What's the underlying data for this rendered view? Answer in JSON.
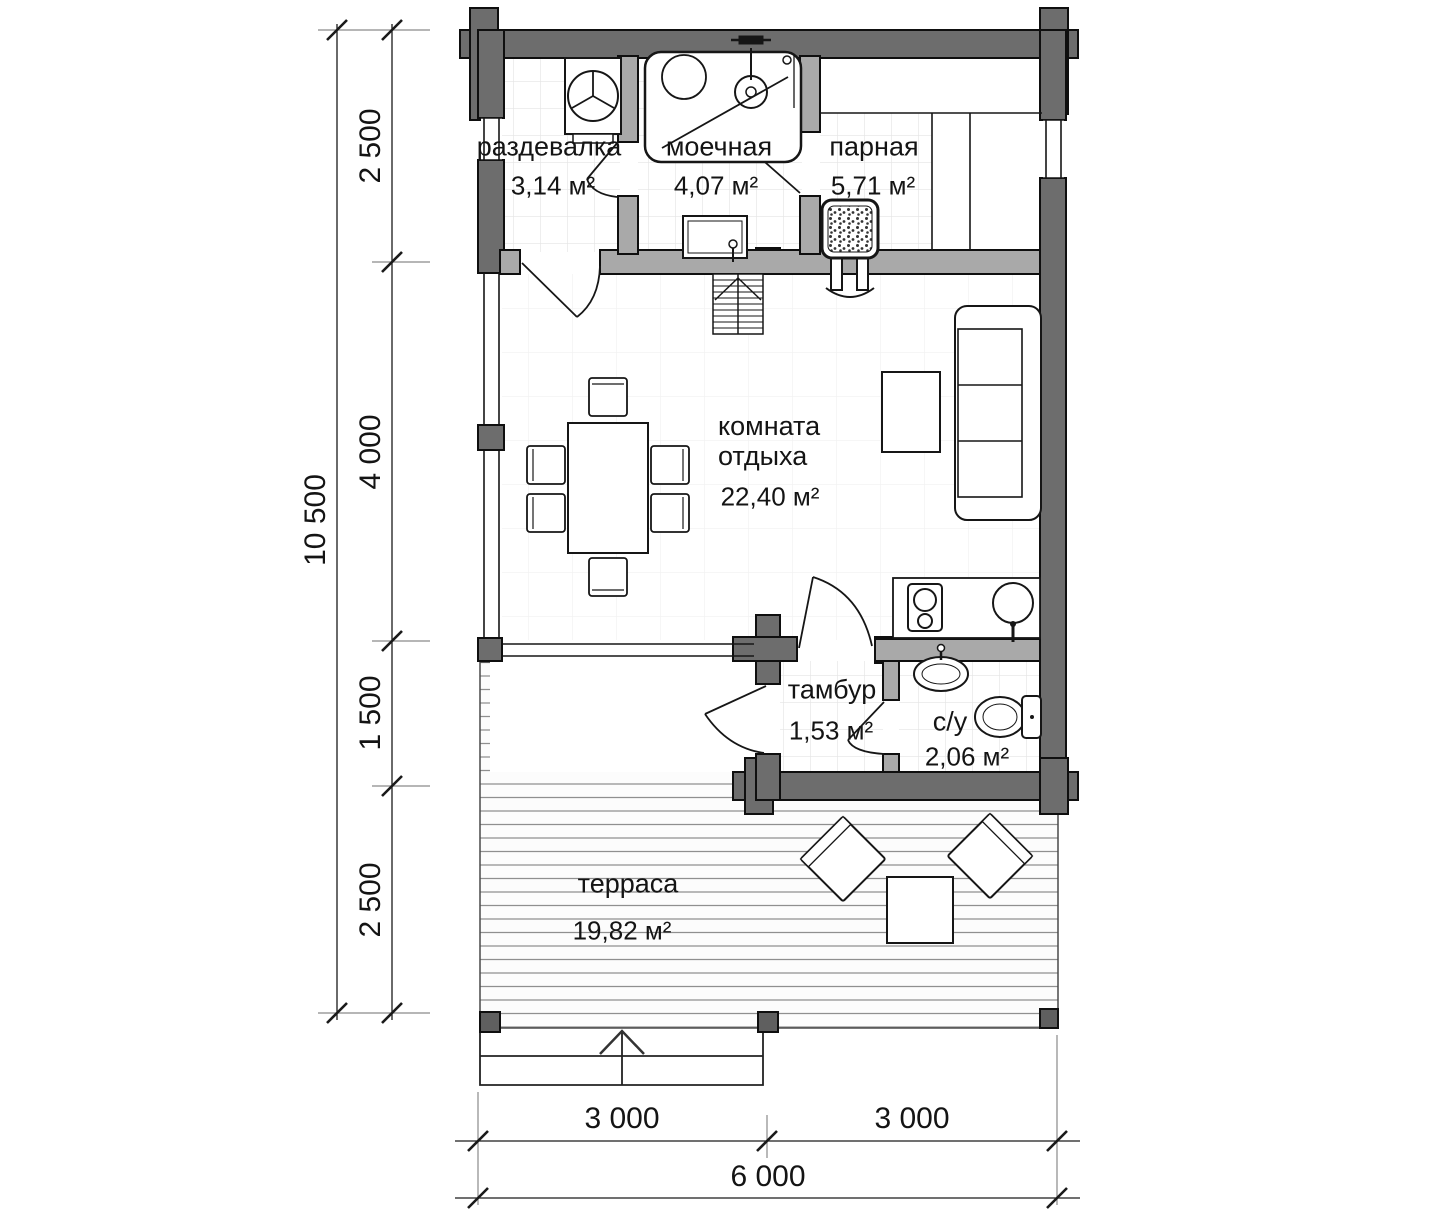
{
  "plan": {
    "rooms": {
      "razdevalka": {
        "name": "раздевалка",
        "area": "3,14 м²"
      },
      "moechnaya": {
        "name": "моечная",
        "area": "4,07 м²"
      },
      "parnaya": {
        "name": "парная",
        "area": "5,71 м²"
      },
      "komnata_otdyha": {
        "name": "комната отдыха",
        "area": "22,40 м²"
      },
      "tambur": {
        "name": "тамбур",
        "area": "1,53 м²"
      },
      "su": {
        "name": "с/у",
        "area": "2,06 м²"
      },
      "terrasa": {
        "name": "терраса",
        "area": "19,82 м²"
      }
    },
    "dimensions": {
      "vertical_total": "10 500",
      "vertical_segments": [
        "2 500",
        "4 000",
        "1 500",
        "2 500"
      ],
      "horizontal_segments": [
        "3 000",
        "3 000"
      ],
      "horizontal_total": "6 000"
    },
    "colors": {
      "wall_exterior": "#6d6d6d",
      "wall_interior": "#a9a9a9",
      "line": "#111111",
      "background": "#ffffff"
    }
  }
}
